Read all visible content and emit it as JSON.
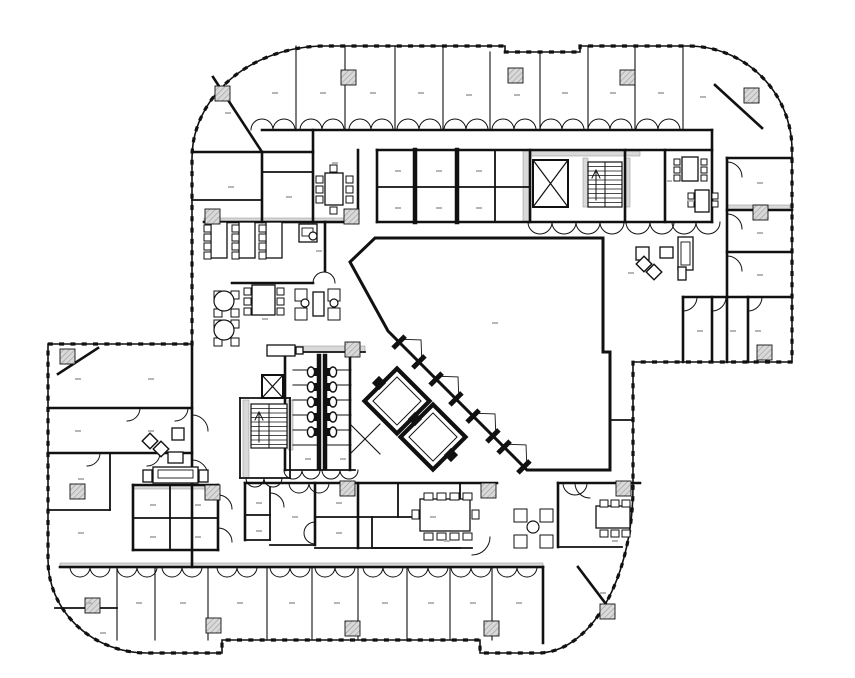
{
  "meta": {
    "canvas_w": 855,
    "canvas_h": 678,
    "bg_color": "#ffffff",
    "ink_color": "#111111",
    "hatch_color": "#d9d9d9",
    "label_color": "#b5b5b5"
  },
  "floorplan": {
    "envelope": "M 192 344 L 192 158 A 133 112 0 0 1 325 46 L 505 46 L 505 52 L 580 52 L 580 46 L 688 46 A 104 104 0 0 1 792 150 L 792 362 L 633 362 L 633 487 A 95 166 0 0 1 538 653 L 480 653 L 480 640 L 222 640 L 222 653 L 147 653 A 99 93 0 0 1 48 560 L 48 344 Z",
    "atrium": "M 350 262 L 375 238 L 603 238 L 603 352 L 610 352 L 610 470 L 527 470 L 388 331 Z",
    "gray_bands": [
      [
        204,
        218,
        148,
        5
      ],
      [
        530,
        151,
        110,
        5
      ],
      [
        523,
        150,
        8,
        72
      ],
      [
        727,
        205,
        63,
        5
      ],
      [
        285,
        346,
        80,
        6
      ],
      [
        243,
        400,
        6,
        78
      ],
      [
        288,
        400,
        5,
        50
      ],
      [
        583,
        158,
        5,
        49
      ],
      [
        625,
        158,
        5,
        49
      ],
      [
        60,
        563,
        483,
        5
      ],
      [
        133,
        485,
        74,
        4
      ]
    ],
    "walls_heavy": [
      "M 262 130 L 712 130",
      "M 213 77 L 262 152",
      "M 192 152 L 313 152",
      "M 262 152 L 262 222",
      "M 313 130 L 313 222",
      "M 358 150 L 358 222",
      "M 204 222 L 352 222",
      "M 325 222 L 325 271",
      "M 232 283 L 313 283",
      "M 377 150 L 712 150",
      "M 377 150 L 377 222",
      "M 530 150 L 530 222",
      "M 377 222 L 712 222",
      "M 625 150 L 625 222",
      "M 665 150 L 665 222",
      "M 712 130 L 712 222",
      "M 715 85 L 762 128",
      "M 727 158 L 727 362",
      "M 727 158 L 792 158",
      "M 727 210 L 792 210",
      "M 727 252 L 792 252",
      "M 683 297 L 792 297",
      "M 683 297 L 683 362",
      "M 712 297 L 712 362",
      "M 748 297 L 748 362",
      "M 192 344 L 192 567",
      "M 48 408 L 192 408",
      "M 48 453 L 192 453",
      "M 58 374 L 98 348",
      "M 60 567 L 543 567",
      "M 578 567 L 612 612",
      "M 133 485 L 218 485",
      "M 133 485 L 133 550",
      "M 218 485 L 218 550",
      "M 133 550 L 218 550",
      "M 245 483 L 497 483",
      "M 245 483 L 245 540",
      "M 315 483 L 315 545",
      "M 358 483 L 358 548",
      "M 558 483 L 640 483",
      "M 558 483 L 558 547",
      "M 285 352 L 285 470",
      "M 350 352 L 350 470",
      "M 543 567 L 543 643"
    ],
    "walls_medium": [
      "M 377 187 L 530 187",
      "M 495 150 L 495 222",
      "M 192 200 L 262 200",
      "M 262 172 L 313 172",
      "M 110 453 L 110 510",
      "M 48 510 L 110 510",
      "M 55 608 L 117 608",
      "M 170 485 L 170 550",
      "M 133 518 L 218 518",
      "M 270 487 L 270 540",
      "M 245 515 L 270 515",
      "M 245 540 L 270 540",
      "M 270 545 L 315 545",
      "M 315 517 L 460 517",
      "M 460 483 L 460 517",
      "M 315 548 L 460 548",
      "M 398 483 L 398 517",
      "M 372 517 L 372 548",
      "M 372 548 L 472 548",
      "M 558 547 L 622 547",
      "M 285 352 L 365 352",
      "M 285 470 L 355 470",
      "M 240 398 L 290 398",
      "M 240 478 L 290 478",
      "M 290 398 L 290 478",
      "M 240 398 L 240 478",
      "M 610 420 L 633 420"
    ],
    "walls_light": [
      "M 117 567 L 117 640",
      "M 155 567 L 155 640",
      "M 208 567 L 208 640",
      "M 267 567 L 267 640",
      "M 312 567 L 312 640",
      "M 358 567 L 358 640",
      "M 407 567 L 407 640",
      "M 450 567 L 450 640",
      "M 492 567 L 492 640",
      "M 296 46 L 296 130",
      "M 345 46 L 345 130",
      "M 395 46 L 395 130",
      "M 443 46 L 443 130",
      "M 490 52 L 490 130",
      "M 540 52 L 540 130",
      "M 588 46 L 588 130",
      "M 635 46 L 635 130",
      "M 683 46 L 683 130",
      "M 293 370 L 319 370",
      "M 293 385 L 319 385",
      "M 293 400 L 319 400",
      "M 293 415 L 319 415",
      "M 293 430 L 319 430",
      "M 293 445 L 319 445",
      "M 325 370 L 351 370",
      "M 325 385 L 351 385",
      "M 325 400 L 351 400",
      "M 325 415 L 351 415",
      "M 325 430 L 351 430",
      "M 325 445 L 351 445",
      "M 350 424 L 380 454",
      "M 380 424 L 350 454"
    ],
    "wall_bars": [
      "M 415 150 L 415 222",
      "M 457 150 L 457 222",
      "M 319 356 L 319 468",
      "M 325 356 L 325 468"
    ],
    "door_arcs": [
      "M 727 162 A 15 15 0 0 1 742 177",
      "M 727 214 A 15 15 0 0 1 742 229",
      "M 727 256 A 15 15 0 0 1 742 271",
      "M 697 297 A 14 14 0 0 1 683 311",
      "M 726 297 A 14 14 0 0 1 712 311",
      "M 762 297 A 14 14 0 0 1 748 311",
      "M 192 415 A 16 16 0 0 1 208 431",
      "M 192 460 A 16 16 0 0 1 208 476",
      "M 140 408 A 13 13 0 0 1 127 421",
      "M 188 408 A 13 13 0 0 1 175 421",
      "M 100 453 A 13 13 0 0 1 87 466",
      "M 160 453 A 13 13 0 0 1 147 466",
      "M 218 495 A 14 14 0 0 1 232 509",
      "M 218 528 A 14 14 0 0 1 232 542",
      "M 270 493 A 14 14 0 0 1 284 507",
      "M 490 537 A 18 18 0 0 1 472 555",
      "M 575 483 A 15 15 0 0 0 590 498",
      "M 313 283 A 11 11 0 0 1 335 283",
      "M 563 483 A 12 12 0 0 0 587 483",
      "M 315 522 A 11 11 0 0 0 315 544"
    ],
    "door_bumps": [
      {
        "y": 130,
        "r": 11,
        "dir": "up",
        "cx": [
          273,
          322,
          371,
          419,
          466,
          514,
          562,
          610,
          658
        ]
      },
      {
        "y": 567,
        "r": 10,
        "dir": "down",
        "cx": [
          90,
          137,
          182,
          237,
          290,
          335,
          383,
          428,
          471,
          517
        ]
      },
      {
        "y": 222,
        "r": 12,
        "dir": "down",
        "cx": [
          552,
          600,
          650,
          696
        ]
      },
      {
        "y": 470,
        "r": 9,
        "dir": "down",
        "cx": [
          302,
          340
        ]
      },
      {
        "y": 478,
        "r": 9,
        "dir": "down",
        "cx": [
          264
        ]
      },
      {
        "y": 483,
        "r": 10,
        "dir": "down",
        "cx": [
          309
        ]
      }
    ],
    "columns": [
      [
        215,
        86
      ],
      [
        341,
        70
      ],
      [
        508,
        68
      ],
      [
        620,
        70
      ],
      [
        744,
        88
      ],
      [
        753,
        205
      ],
      [
        757,
        345
      ],
      [
        600,
        604
      ],
      [
        345,
        342
      ],
      [
        205,
        209
      ],
      [
        344,
        209
      ],
      [
        60,
        349
      ],
      [
        70,
        484
      ],
      [
        85,
        598
      ],
      [
        205,
        485
      ],
      [
        340,
        481
      ],
      [
        481,
        483
      ],
      [
        616,
        481
      ],
      [
        206,
        618
      ],
      [
        345,
        621
      ],
      [
        484,
        621
      ]
    ],
    "shafts": [
      [
        533,
        160,
        35,
        47
      ],
      [
        262,
        375,
        21,
        23
      ]
    ],
    "stairs": [
      {
        "x": 588,
        "y": 162,
        "w": 34,
        "h": 45,
        "divider_x": 605,
        "step": 4.5,
        "arrow": "M 596 200 L 596 172 M 592 178 L 596 170 L 600 178"
      },
      {
        "x": 251,
        "y": 404,
        "w": 36,
        "h": 44,
        "divider_x": 269,
        "step": 4.5,
        "arrow": "M 259 442 L 259 414 M 255 420 L 259 412 L 263 420"
      }
    ],
    "elevator_cars": [
      {
        "cx": 397,
        "cy": 401
      },
      {
        "cx": 433,
        "cy": 437
      }
    ],
    "car_size": 46,
    "junction_blocks": [
      [
        379,
        383
      ],
      [
        415,
        419
      ],
      [
        451,
        455
      ]
    ],
    "diag_doors": [
      [
        409,
        352
      ],
      [
        446,
        389
      ],
      [
        483,
        426
      ],
      [
        514,
        457
      ]
    ],
    "tables": [
      [
        325,
        173,
        18,
        32
      ],
      [
        682,
        157,
        16,
        24
      ],
      [
        211,
        222,
        16,
        36
      ],
      [
        239,
        222,
        16,
        36
      ],
      [
        266,
        222,
        16,
        36
      ],
      [
        299,
        224,
        18,
        18
      ],
      [
        313,
        292,
        11,
        24
      ],
      [
        252,
        285,
        23,
        30
      ],
      [
        420,
        499,
        50,
        32
      ],
      [
        596,
        506,
        34,
        22
      ],
      [
        678,
        237,
        15,
        33
      ],
      [
        153,
        467,
        45,
        16
      ],
      [
        172,
        428,
        12,
        12
      ],
      [
        168,
        452,
        15,
        11
      ],
      [
        143,
        470,
        9,
        12
      ],
      [
        199,
        470,
        9,
        12
      ],
      [
        636,
        247,
        13,
        13
      ],
      [
        660,
        247,
        13,
        11
      ],
      [
        678,
        267,
        8,
        13
      ],
      [
        695,
        190,
        14,
        22
      ],
      [
        267,
        345,
        28,
        11
      ],
      [
        296,
        347,
        7,
        7
      ]
    ],
    "insets": [
      [
        681,
        242,
        9,
        23
      ],
      [
        158,
        470,
        35,
        8
      ],
      [
        302,
        228,
        11,
        8
      ]
    ],
    "chairs": [
      [
        316,
        176,
        7,
        7
      ],
      [
        316,
        186,
        7,
        7
      ],
      [
        316,
        196,
        7,
        7
      ],
      [
        346,
        176,
        7,
        7
      ],
      [
        346,
        186,
        7,
        7
      ],
      [
        346,
        196,
        7,
        7
      ],
      [
        330,
        165,
        7,
        7
      ],
      [
        330,
        207,
        7,
        7
      ],
      [
        674,
        159,
        6,
        6
      ],
      [
        674,
        167,
        6,
        6
      ],
      [
        674,
        175,
        6,
        6
      ],
      [
        701,
        159,
        6,
        6
      ],
      [
        701,
        167,
        6,
        6
      ],
      [
        701,
        175,
        6,
        6
      ],
      [
        688,
        193,
        6,
        6
      ],
      [
        688,
        201,
        6,
        6
      ],
      [
        712,
        193,
        6,
        6
      ],
      [
        712,
        201,
        6,
        6
      ],
      [
        204,
        225,
        7,
        7
      ],
      [
        204,
        234,
        7,
        7
      ],
      [
        204,
        243,
        7,
        7
      ],
      [
        204,
        252,
        7,
        7
      ],
      [
        232,
        225,
        7,
        7
      ],
      [
        232,
        234,
        7,
        7
      ],
      [
        232,
        243,
        7,
        7
      ],
      [
        232,
        252,
        7,
        7
      ],
      [
        259,
        225,
        7,
        7
      ],
      [
        259,
        234,
        7,
        7
      ],
      [
        259,
        243,
        7,
        7
      ],
      [
        259,
        252,
        7,
        7
      ],
      [
        244,
        288,
        7,
        7
      ],
      [
        244,
        298,
        7,
        7
      ],
      [
        244,
        308,
        7,
        7
      ],
      [
        277,
        288,
        7,
        7
      ],
      [
        277,
        298,
        7,
        7
      ],
      [
        277,
        308,
        7,
        7
      ],
      [
        214,
        291,
        8,
        8
      ],
      [
        231,
        291,
        8,
        8
      ],
      [
        214,
        309,
        8,
        8
      ],
      [
        231,
        309,
        8,
        8
      ],
      [
        214,
        320,
        8,
        8
      ],
      [
        231,
        320,
        8,
        8
      ],
      [
        214,
        338,
        8,
        8
      ],
      [
        231,
        338,
        8,
        8
      ],
      [
        295,
        289,
        12,
        12
      ],
      [
        295,
        308,
        12,
        12
      ],
      [
        328,
        289,
        12,
        12
      ],
      [
        328,
        308,
        12,
        12
      ],
      [
        424,
        493,
        9,
        7
      ],
      [
        437,
        493,
        9,
        7
      ],
      [
        450,
        493,
        9,
        7
      ],
      [
        463,
        493,
        9,
        7
      ],
      [
        424,
        533,
        9,
        7
      ],
      [
        437,
        533,
        9,
        7
      ],
      [
        450,
        533,
        9,
        7
      ],
      [
        463,
        533,
        9,
        7
      ],
      [
        412,
        510,
        7,
        9
      ],
      [
        472,
        510,
        7,
        9
      ],
      [
        600,
        500,
        8,
        7
      ],
      [
        611,
        500,
        8,
        7
      ],
      [
        622,
        500,
        8,
        7
      ],
      [
        600,
        530,
        8,
        7
      ],
      [
        611,
        530,
        8,
        7
      ],
      [
        622,
        530,
        8,
        7
      ],
      [
        514,
        509,
        13,
        13
      ],
      [
        540,
        509,
        13,
        13
      ],
      [
        514,
        535,
        13,
        13
      ],
      [
        540,
        535,
        13,
        13
      ]
    ],
    "diamonds": [
      [
        150,
        441,
        11
      ],
      [
        161,
        449,
        11
      ],
      [
        644,
        264,
        11
      ],
      [
        654,
        272,
        11
      ]
    ],
    "circles": [
      [
        313,
        236,
        4
      ],
      [
        224,
        301,
        10
      ],
      [
        224,
        330,
        10
      ],
      [
        533,
        527,
        6
      ],
      [
        305,
        303,
        4
      ],
      [
        334,
        303,
        4
      ]
    ],
    "toilets": {
      "left_x": 311,
      "right_x": 333,
      "ys": [
        372,
        387,
        402,
        417,
        432
      ]
    },
    "label_marks": [
      [
        272,
        92
      ],
      [
        320,
        92
      ],
      [
        370,
        92
      ],
      [
        418,
        92
      ],
      [
        466,
        94
      ],
      [
        514,
        94
      ],
      [
        562,
        92
      ],
      [
        610,
        92
      ],
      [
        658,
        92
      ],
      [
        700,
        96
      ],
      [
        225,
        112
      ],
      [
        228,
        186
      ],
      [
        286,
        196
      ],
      [
        332,
        162
      ],
      [
        395,
        170
      ],
      [
        436,
        170
      ],
      [
        476,
        170
      ],
      [
        395,
        207
      ],
      [
        436,
        207
      ],
      [
        476,
        207
      ],
      [
        688,
        200
      ],
      [
        757,
        182
      ],
      [
        757,
        232
      ],
      [
        757,
        274
      ],
      [
        755,
        330
      ],
      [
        697,
        330
      ],
      [
        730,
        330
      ],
      [
        628,
        272
      ],
      [
        492,
        322
      ],
      [
        316,
        250
      ],
      [
        262,
        318
      ],
      [
        305,
        458
      ],
      [
        340,
        458
      ],
      [
        75,
        378
      ],
      [
        75,
        430
      ],
      [
        78,
        478
      ],
      [
        78,
        532
      ],
      [
        148,
        378
      ],
      [
        148,
        430
      ],
      [
        150,
        504
      ],
      [
        150,
        536
      ],
      [
        195,
        504
      ],
      [
        195,
        536
      ],
      [
        256,
        502
      ],
      [
        256,
        530
      ],
      [
        292,
        516
      ],
      [
        336,
        502
      ],
      [
        336,
        532
      ],
      [
        430,
        516
      ],
      [
        444,
        540
      ],
      [
        612,
        540
      ],
      [
        86,
        602
      ],
      [
        136,
        602
      ],
      [
        180,
        602
      ],
      [
        237,
        602
      ],
      [
        289,
        602
      ],
      [
        334,
        602
      ],
      [
        382,
        602
      ],
      [
        428,
        602
      ],
      [
        470,
        602
      ],
      [
        516,
        602
      ],
      [
        600,
        592
      ],
      [
        100,
        632
      ],
      [
        666,
        180
      ]
    ]
  }
}
